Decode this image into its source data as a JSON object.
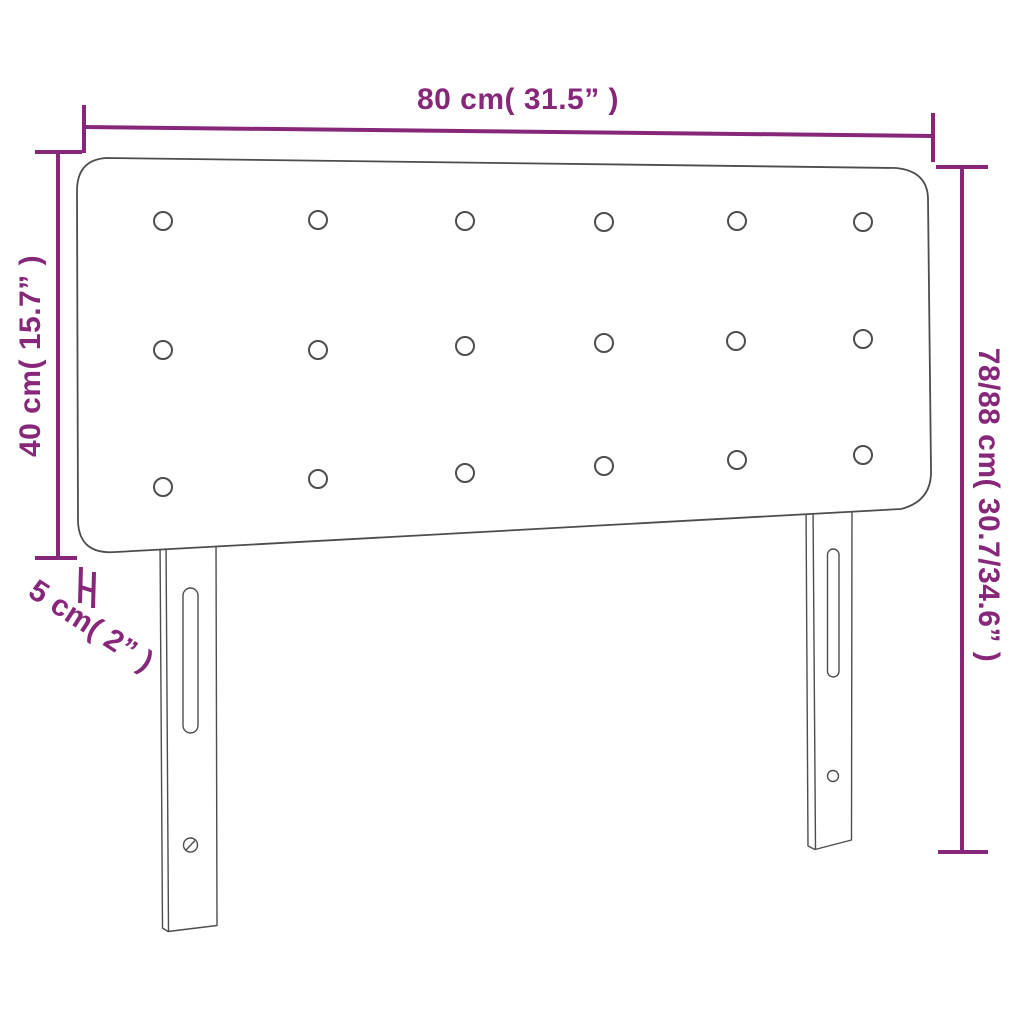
{
  "diagram": {
    "kind": "product-dimension-diagram",
    "dimensions": {
      "width_label": "80 cm( 31.5” )",
      "panel_height_label": "40 cm( 15.7” )",
      "total_height_label": "78/88 cm( 30.7/34.6” )",
      "thickness_label": "5 cm( 2” )"
    },
    "button_count": 18
  },
  "colors": {
    "dimension_accent": "#872779",
    "outline": "#4d4d4d",
    "background": "#ffffff"
  }
}
